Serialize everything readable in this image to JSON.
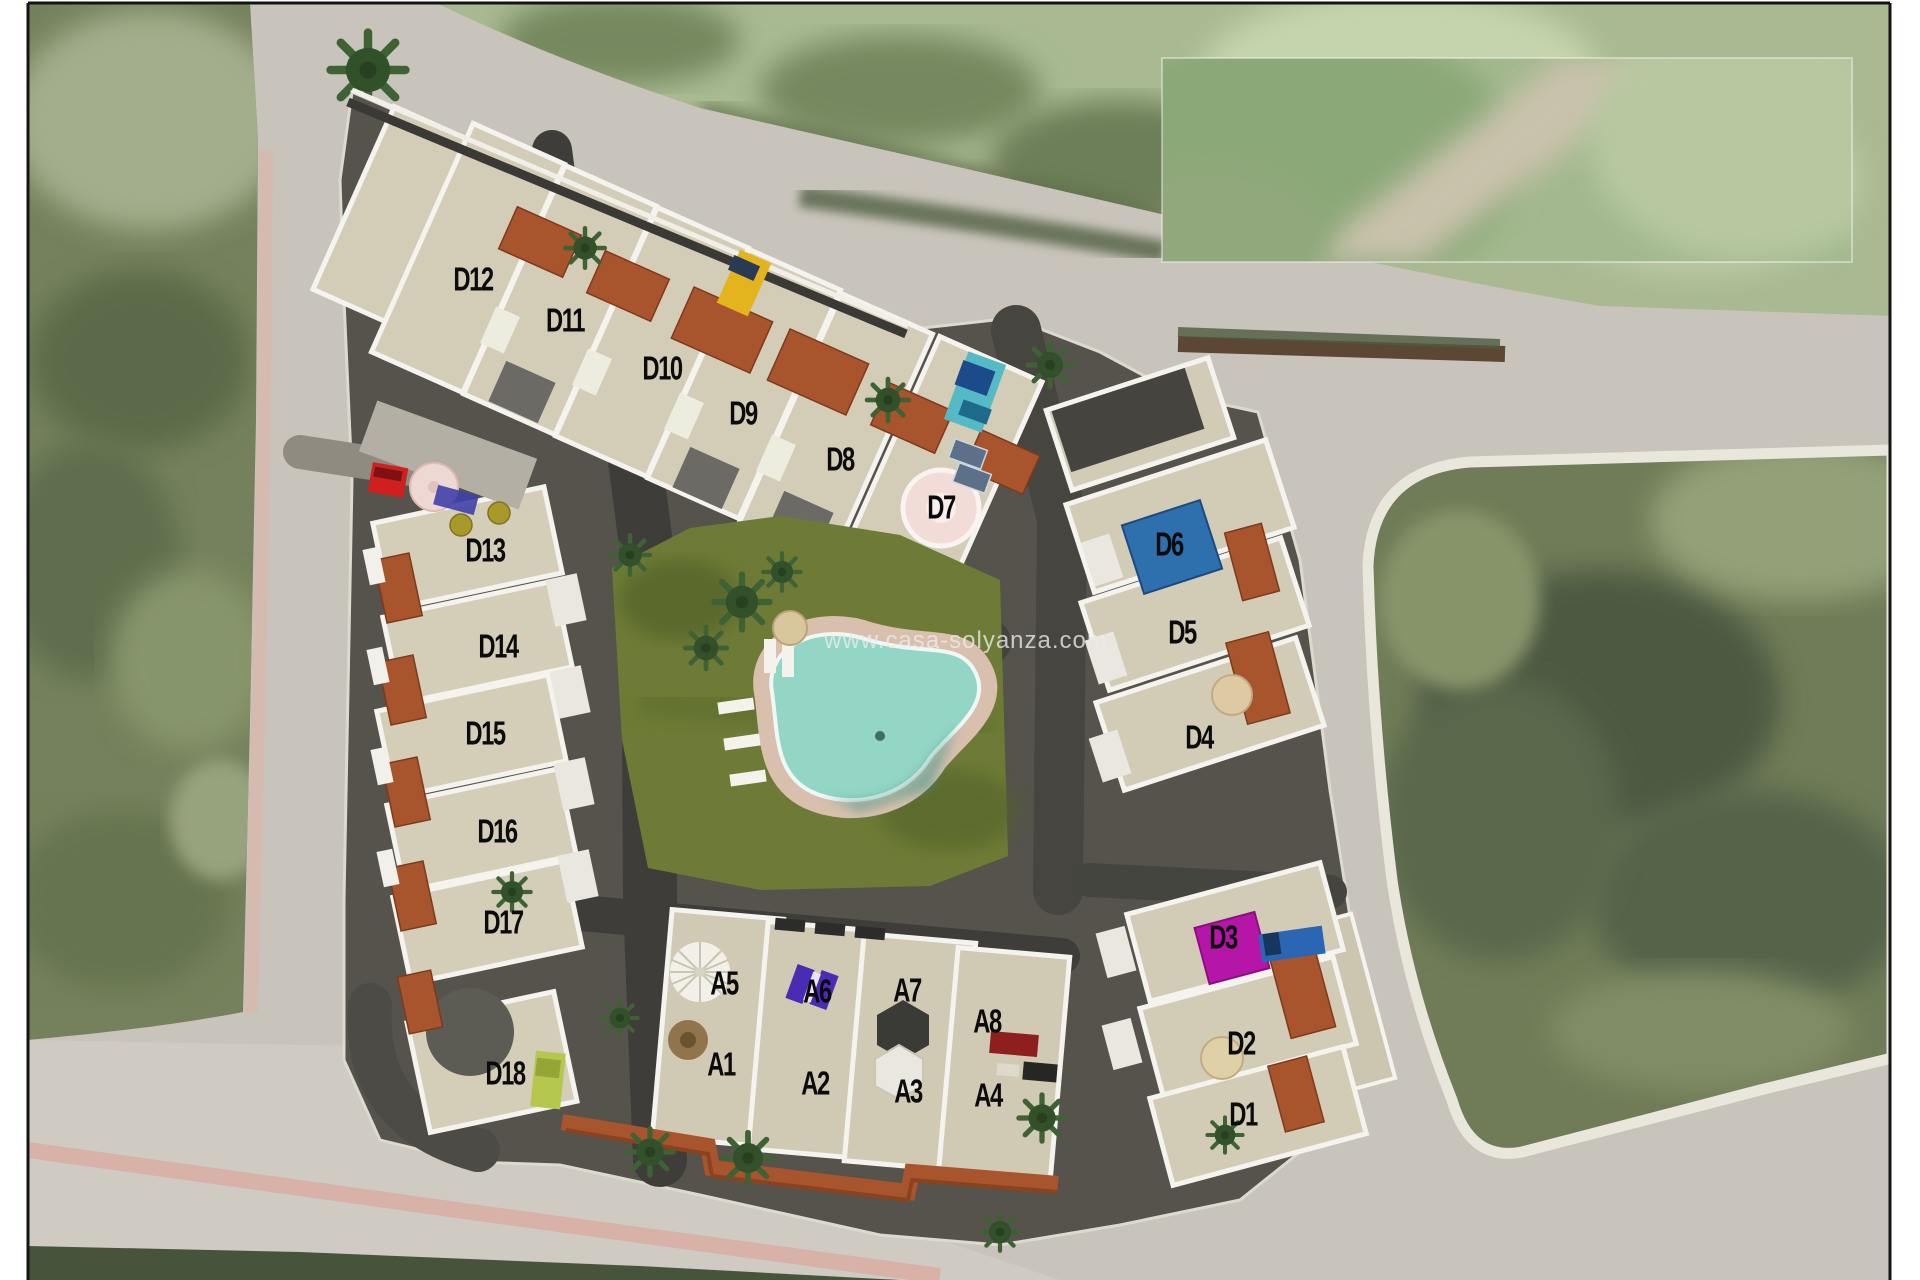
{
  "watermark": {
    "text": "www.casa-solyanza.com"
  },
  "units": {
    "d12": "D12",
    "d11": "D11",
    "d10": "D10",
    "d9": "D9",
    "d8": "D8",
    "d7": "D7",
    "d13": "D13",
    "d14": "D14",
    "d15": "D15",
    "d16": "D16",
    "d17": "D17",
    "d18": "D18",
    "d6": "D6",
    "d5": "D5",
    "d4": "D4",
    "d3": "D3",
    "d2": "D2",
    "d1": "D1",
    "a5": "A5",
    "a6": "A6",
    "a7": "A7",
    "a8": "A8",
    "a1": "A1",
    "a2": "A2",
    "a3": "A3",
    "a4": "A4"
  },
  "colors": {
    "cover_blue": "#2e6fae",
    "cover_magenta": "#b616a8",
    "pool_water": "#93d6c6",
    "lawn_green": "#6d7b36",
    "roof_terracotta": "#a8542c",
    "terrace_tan": "#d3cdb7",
    "road_gray": "#c9c4bb",
    "field_green_dark": "#6f7c57",
    "field_green_light": "#a9ba92",
    "label_black": "#0b0b0b"
  },
  "features": [
    "swimming-pool",
    "lawn-courtyard",
    "palm-tree-icon",
    "sun-umbrella-icon",
    "parked-car-icon",
    "roof-terrace",
    "terracotta-roof",
    "stairs",
    "satellite-roads"
  ]
}
